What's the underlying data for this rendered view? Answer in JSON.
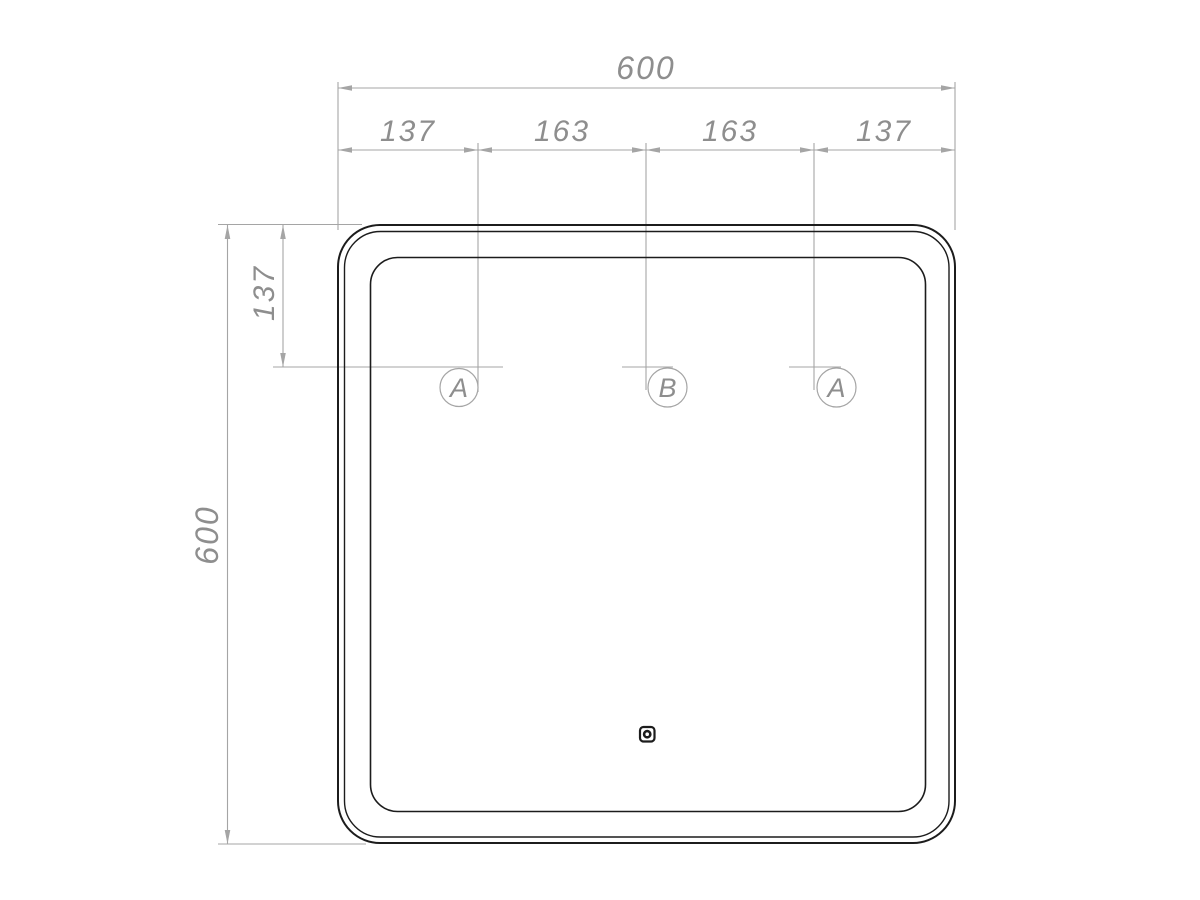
{
  "colors": {
    "outline": "#1c1c1c",
    "dim_line": "#a5a5a5",
    "dim_text": "#8e8e8e",
    "background": "#ffffff"
  },
  "dimensions": {
    "total_width": "600",
    "width_segments": [
      "137",
      "163",
      "163",
      "137"
    ],
    "total_height": "600",
    "top_offset": "137"
  },
  "mounting_points": [
    {
      "label": "A"
    },
    {
      "label": "B"
    },
    {
      "label": "A"
    }
  ],
  "icons": {
    "touch_sensor": "touch-sensor-icon"
  }
}
